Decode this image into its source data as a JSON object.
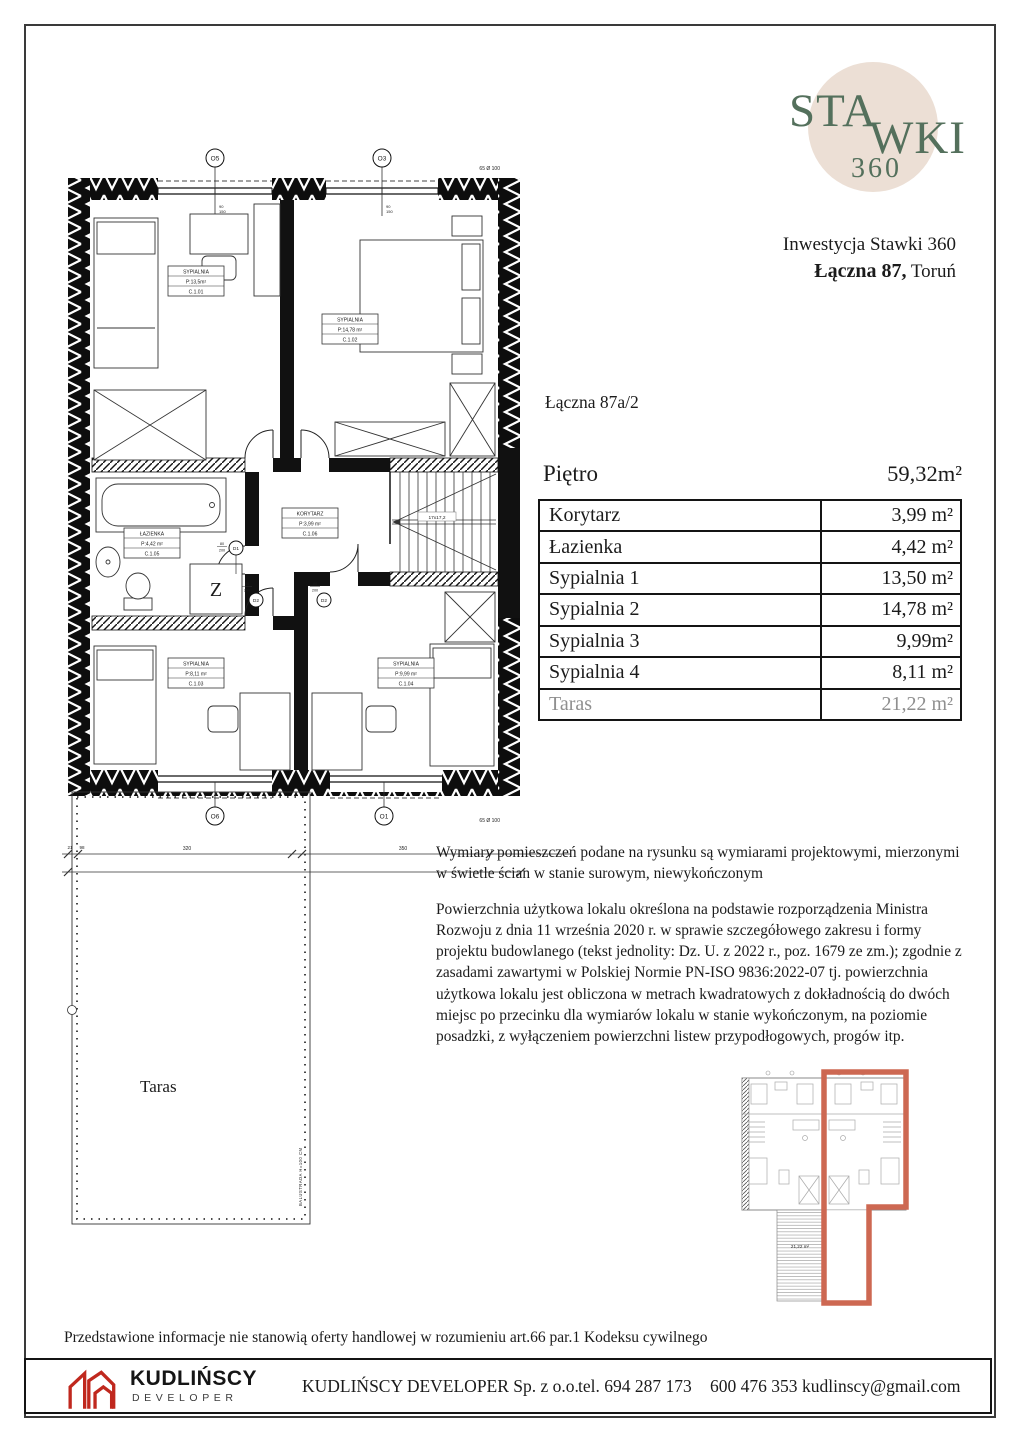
{
  "brand": {
    "logo_sta": "STA",
    "logo_wki": "WKI",
    "logo_360": "360",
    "circle_color": "#ecdfd5",
    "text_color": "#54705c",
    "investment": "Inwestycja Stawki 360",
    "address_bold": "Łączna 87,",
    "address_city": " Toruń"
  },
  "unit": {
    "title": "Łączna 87a/2",
    "floor_label": "Piętro",
    "floor_area": "59,32m²"
  },
  "table": {
    "rows": [
      {
        "label": "Korytarz",
        "value": "3,99 m²"
      },
      {
        "label": "Łazienka",
        "value": "4,42 m²"
      },
      {
        "label": "Sypialnia 1",
        "value": "13,50 m²"
      },
      {
        "label": "Sypialnia 2",
        "value": "14,78 m²"
      },
      {
        "label": "Sypialnia 3",
        "value": "9,99m²"
      },
      {
        "label": "Sypialnia 4",
        "value": "8,11 m²"
      },
      {
        "label": "Taras",
        "value": "21,22 m²"
      }
    ]
  },
  "notes": {
    "p1": "Wymiary pomieszczeń podane na rysunku są wymiarami projektowymi, mierzonymi w świetle ścian w stanie surowym, niewykończonym",
    "p2": "Powierzchnia użytkowa lokalu określona na podstawie rozporządzenia Ministra Rozwoju z dnia 11 września 2020 r. w sprawie szczegółowego zakresu i formy projektu budowlanego (tekst jednolity: Dz. U. z 2022 r., poz. 1679 ze zm.); zgodnie z zasadami zawartymi w Polskiej Normie PN-ISO 9836:2022-07 tj. powierzchnia użytkowa lokalu jest obliczona w metrach kwadratowych z dokładnością do dwóch miejsc po przecinku dla wymiarów lokalu w stanie wykończonym, na poziomie posadzki, z wyłączeniem powierzchni listew przypodłogowych, progów itp."
  },
  "disclaimer": "Przedstawione informacje nie stanowią oferty handlowej w rozumieniu art.66 par.1 Kodeksu cywilnego",
  "footer": {
    "logo_name": "KUDLIŃSCY",
    "logo_sub": "DEVELOPER",
    "logo_red": "#c0281e",
    "company": "KUDLIŃSCY DEVELOPER Sp. z o.o.",
    "phone1": "tel. 694 287 173",
    "phone2": "600 476 353",
    "email": "kudlinscy@gmail.com"
  },
  "plan": {
    "rooms": [
      {
        "name": "SYPIALNIA",
        "area": "P:13,5m²",
        "code": "C.1.01"
      },
      {
        "name": "SYPIALNIA",
        "area": "P:14,78 m²",
        "code": "C.1.02"
      },
      {
        "name": "ŁAZIENKA",
        "area": "P:4,42 m²",
        "code": "C.1.05"
      },
      {
        "name": "KORYTARZ",
        "area": "P:3,99 m²",
        "code": "C.1.06"
      },
      {
        "name": "SYPIALNIA",
        "area": "P:8,11 m²",
        "code": "C.1.03"
      },
      {
        "name": "SYPIALNIA",
        "area": "P:9,99 m²",
        "code": "C.1.04"
      }
    ],
    "window_marks": [
      "O5",
      "O3",
      "O6",
      "O1"
    ],
    "door_marks": [
      "D1",
      "D2",
      "D2"
    ],
    "door_w": "80",
    "door_h": "200",
    "win_a": "90",
    "win_b": "150",
    "washer": "Z",
    "stairs_note": "17x17,2",
    "vent_note": "65 Ø 100",
    "dims": {
      "d1": "21",
      "d2": "98",
      "d3": "320",
      "d4": "350"
    },
    "terrace_label": "Taras",
    "balustrade": "BALUSTRADA H=100 CM"
  },
  "miniplan": {
    "area_label": "21,22 m²",
    "outline_color": "#cd6852"
  }
}
